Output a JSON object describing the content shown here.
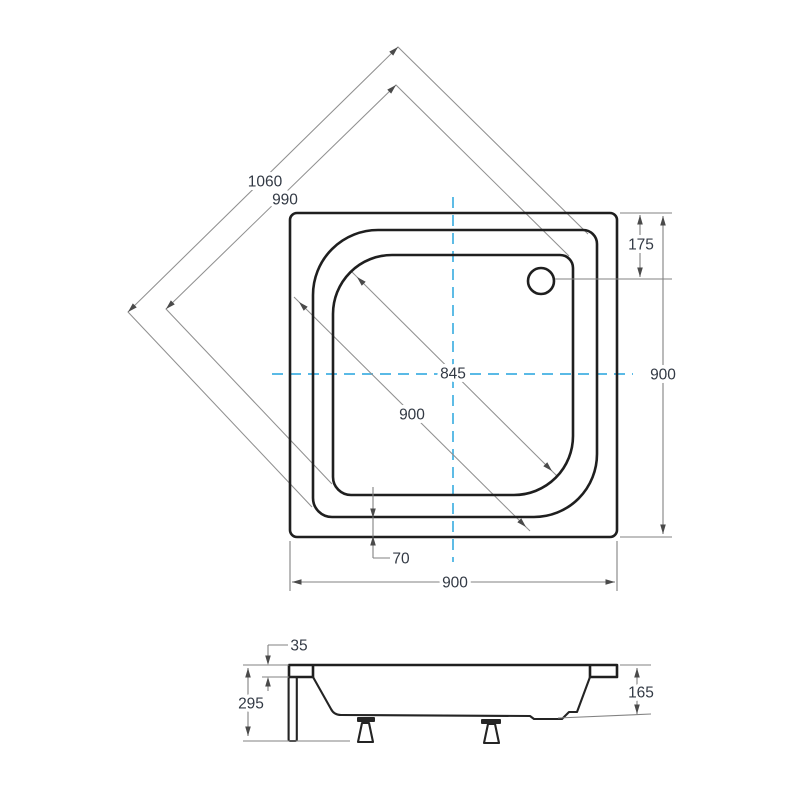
{
  "drawing": {
    "type": "technical-drawing",
    "subject": "square shower tray with front panel - top plan view and side section view",
    "units": "mm",
    "colors": {
      "outline": "#1f1f1f",
      "dimension_line": "#828282",
      "centerline": "#43b0e2",
      "dimension_text": "#333a45",
      "background": "#ffffff"
    },
    "labels": {
      "diag_outer": "1060",
      "diag_inner": "990",
      "drain_offset": "175",
      "height_right": "900",
      "basin_diag": "845",
      "mid_diag": "900",
      "apron": "70",
      "width_bottom": "900",
      "panel_top_inset": "35",
      "total_height": "295",
      "tray_depth": "165"
    }
  }
}
